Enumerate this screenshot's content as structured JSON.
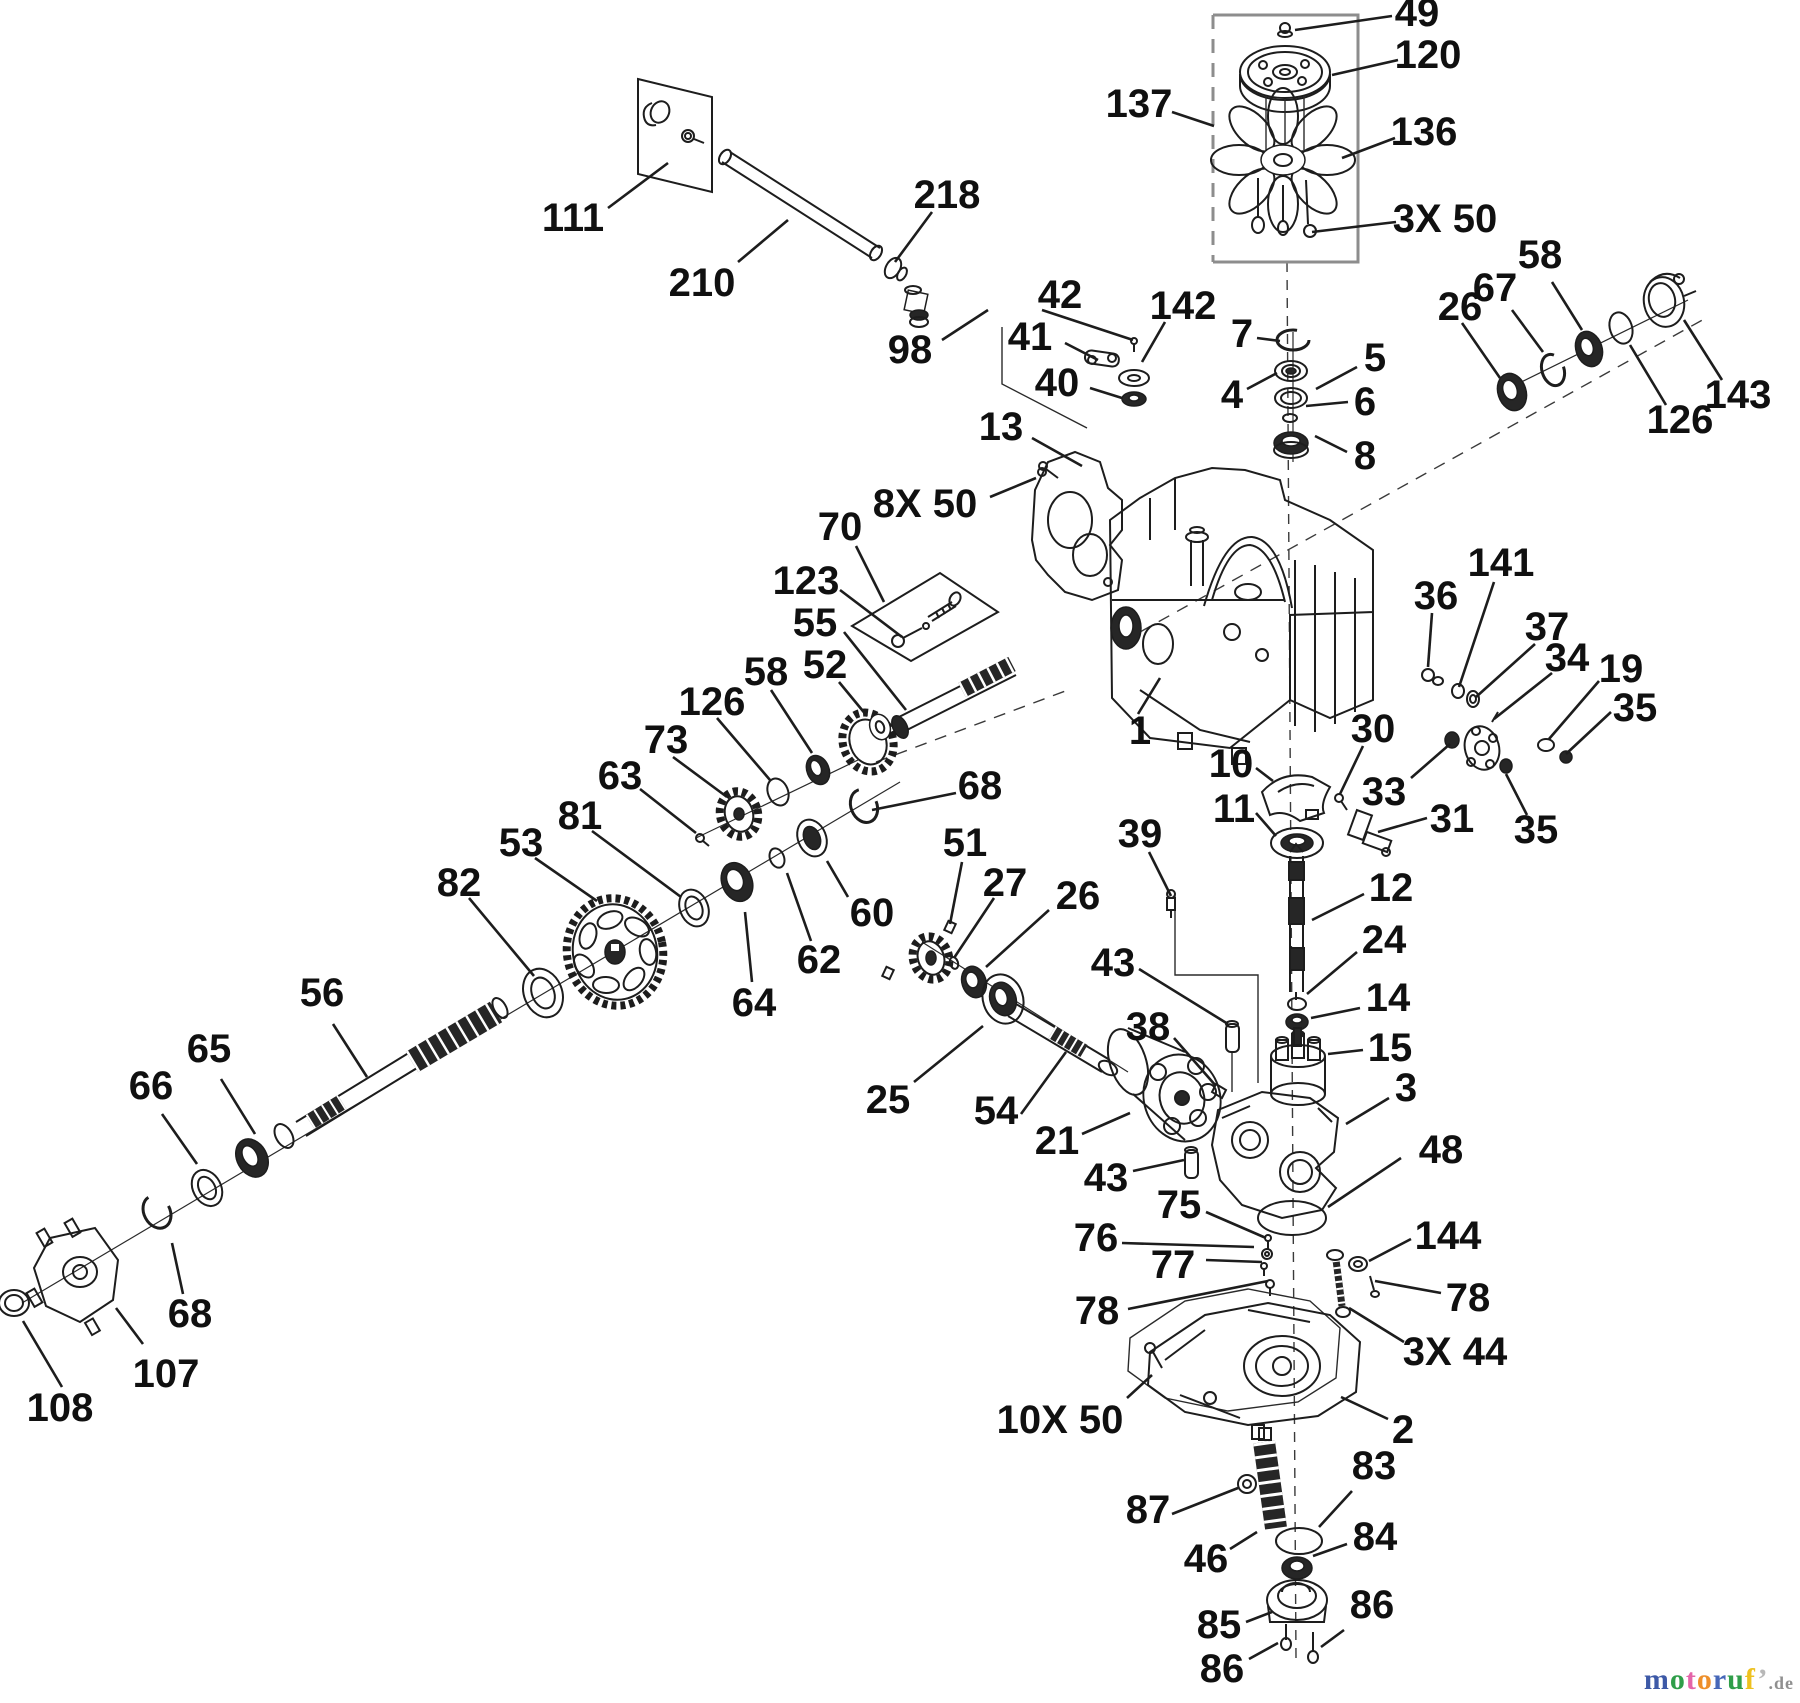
{
  "diagram": {
    "type": "exploded-parts-diagram",
    "ink_color": "#1d1d1d",
    "gray_color": "#8d8d8d",
    "background": "#ffffff"
  },
  "watermark": {
    "letters": [
      {
        "ch": "m",
        "color": "#3d59a7"
      },
      {
        "ch": "o",
        "color": "#2f9e49"
      },
      {
        "ch": "t",
        "color": "#e464a9"
      },
      {
        "ch": "o",
        "color": "#ee8f2a"
      },
      {
        "ch": "r",
        "color": "#4667b8"
      },
      {
        "ch": "u",
        "color": "#2f9e49"
      },
      {
        "ch": "f",
        "color": "#eec11f"
      },
      {
        "ch": "’",
        "color": "#b8b8b8"
      }
    ],
    "suffix": ".de",
    "suffix_color": "#909090"
  },
  "labels": [
    {
      "t": "49",
      "x": 1417,
      "y": 13,
      "l": [
        1392,
        16,
        1295,
        30
      ]
    },
    {
      "t": "120",
      "x": 1428,
      "y": 55,
      "l": [
        1398,
        60,
        1332,
        75
      ]
    },
    {
      "t": "137",
      "x": 1139,
      "y": 104,
      "l": [
        1172,
        112,
        1214,
        126
      ]
    },
    {
      "t": "136",
      "x": 1424,
      "y": 132,
      "l": [
        1395,
        138,
        1342,
        158
      ]
    },
    {
      "t": "3X 50",
      "x": 1445,
      "y": 219,
      "l": [
        1396,
        222,
        1312,
        232
      ]
    },
    {
      "t": "111",
      "x": 573,
      "y": 218,
      "l": [
        608,
        208,
        668,
        163
      ]
    },
    {
      "t": "210",
      "x": 702,
      "y": 283,
      "l": [
        738,
        262,
        788,
        220
      ]
    },
    {
      "t": "218",
      "x": 947,
      "y": 195,
      "l": [
        932,
        212,
        895,
        262
      ]
    },
    {
      "t": "98",
      "x": 910,
      "y": 350,
      "l": [
        942,
        340,
        988,
        310
      ]
    },
    {
      "t": "42",
      "x": 1060,
      "y": 295,
      "l": [
        1042,
        310,
        1133,
        340
      ]
    },
    {
      "t": "41",
      "x": 1030,
      "y": 337,
      "l": [
        1065,
        343,
        1098,
        360
      ]
    },
    {
      "t": "40",
      "x": 1057,
      "y": 383,
      "l": [
        1090,
        388,
        1122,
        398
      ]
    },
    {
      "t": "142",
      "x": 1183,
      "y": 306,
      "l": [
        1165,
        322,
        1142,
        362
      ]
    },
    {
      "t": "7",
      "x": 1242,
      "y": 334,
      "l": [
        1257,
        338,
        1280,
        341
      ]
    },
    {
      "t": "4",
      "x": 1232,
      "y": 395,
      "l": [
        1247,
        389,
        1277,
        373
      ]
    },
    {
      "t": "5",
      "x": 1375,
      "y": 358,
      "l": [
        1357,
        367,
        1316,
        389
      ]
    },
    {
      "t": "6",
      "x": 1365,
      "y": 402,
      "l": [
        1348,
        402,
        1306,
        406
      ]
    },
    {
      "t": "8",
      "x": 1365,
      "y": 456,
      "l": [
        1347,
        452,
        1315,
        436
      ]
    },
    {
      "t": "13",
      "x": 1001,
      "y": 427,
      "l": [
        1032,
        438,
        1082,
        466
      ]
    },
    {
      "t": "8X 50",
      "x": 925,
      "y": 504,
      "l": [
        990,
        497,
        1036,
        478
      ]
    },
    {
      "t": "26",
      "x": 1460,
      "y": 307,
      "l": [
        1462,
        323,
        1500,
        378
      ]
    },
    {
      "t": "67",
      "x": 1495,
      "y": 288,
      "l": [
        1512,
        310,
        1543,
        352
      ]
    },
    {
      "t": "58",
      "x": 1540,
      "y": 255,
      "l": [
        1552,
        282,
        1582,
        330
      ]
    },
    {
      "t": "143",
      "x": 1738,
      "y": 395,
      "l": [
        1722,
        380,
        1684,
        320
      ]
    },
    {
      "t": "126",
      "x": 1680,
      "y": 420,
      "l": [
        1666,
        405,
        1630,
        345
      ]
    },
    {
      "t": "70",
      "x": 840,
      "y": 527,
      "l": [
        856,
        546,
        884,
        602
      ]
    },
    {
      "t": "123",
      "x": 806,
      "y": 581,
      "l": [
        840,
        590,
        902,
        637
      ]
    },
    {
      "t": "55",
      "x": 815,
      "y": 623,
      "l": [
        844,
        632,
        906,
        710
      ]
    },
    {
      "t": "52",
      "x": 825,
      "y": 665,
      "l": [
        839,
        682,
        867,
        716
      ]
    },
    {
      "t": "58",
      "x": 766,
      "y": 672,
      "l": [
        771,
        690,
        812,
        753
      ]
    },
    {
      "t": "126",
      "x": 712,
      "y": 702,
      "l": [
        717,
        718,
        770,
        780
      ]
    },
    {
      "t": "73",
      "x": 666,
      "y": 740,
      "l": [
        673,
        757,
        727,
        797
      ]
    },
    {
      "t": "63",
      "x": 620,
      "y": 776,
      "l": [
        640,
        789,
        696,
        833
      ]
    },
    {
      "t": "81",
      "x": 580,
      "y": 816,
      "l": [
        592,
        831,
        681,
        897
      ]
    },
    {
      "t": "53",
      "x": 521,
      "y": 843,
      "l": [
        535,
        858,
        597,
        901
      ]
    },
    {
      "t": "82",
      "x": 459,
      "y": 883,
      "l": [
        469,
        898,
        534,
        976
      ]
    },
    {
      "t": "68",
      "x": 980,
      "y": 786,
      "l": [
        956,
        793,
        872,
        810
      ]
    },
    {
      "t": "1",
      "x": 1140,
      "y": 731,
      "l": [
        1138,
        714,
        1160,
        678
      ]
    },
    {
      "t": "36",
      "x": 1436,
      "y": 596,
      "l": [
        1432,
        613,
        1428,
        667
      ]
    },
    {
      "t": "141",
      "x": 1501,
      "y": 563,
      "l": [
        1494,
        582,
        1459,
        687
      ]
    },
    {
      "t": "37",
      "x": 1547,
      "y": 627,
      "l": [
        1535,
        644,
        1476,
        697
      ]
    },
    {
      "t": "34",
      "x": 1567,
      "y": 658,
      "l": [
        1552,
        673,
        1494,
        719
      ]
    },
    {
      "t": "19",
      "x": 1621,
      "y": 669,
      "l": [
        1599,
        681,
        1549,
        739
      ]
    },
    {
      "t": "35",
      "x": 1635,
      "y": 708,
      "l": [
        1611,
        712,
        1566,
        754
      ]
    },
    {
      "t": "30",
      "x": 1373,
      "y": 729,
      "l": [
        1363,
        746,
        1340,
        794
      ]
    },
    {
      "t": "10",
      "x": 1231,
      "y": 764,
      "l": [
        1256,
        768,
        1273,
        781
      ]
    },
    {
      "t": "11",
      "x": 1234,
      "y": 809,
      "l": [
        1256,
        813,
        1276,
        836
      ]
    },
    {
      "t": "33",
      "x": 1384,
      "y": 792,
      "l": [
        1411,
        778,
        1450,
        744
      ]
    },
    {
      "t": "31",
      "x": 1452,
      "y": 819,
      "l": [
        1427,
        818,
        1378,
        832
      ]
    },
    {
      "t": "35",
      "x": 1536,
      "y": 830,
      "l": [
        1527,
        815,
        1506,
        774
      ]
    },
    {
      "t": "39",
      "x": 1140,
      "y": 834,
      "l": [
        1149,
        852,
        1171,
        896
      ]
    },
    {
      "t": "12",
      "x": 1391,
      "y": 888,
      "l": [
        1364,
        894,
        1312,
        920
      ]
    },
    {
      "t": "24",
      "x": 1384,
      "y": 940,
      "l": [
        1357,
        952,
        1307,
        994
      ]
    },
    {
      "t": "14",
      "x": 1388,
      "y": 998,
      "l": [
        1360,
        1008,
        1311,
        1018
      ]
    },
    {
      "t": "15",
      "x": 1390,
      "y": 1048,
      "l": [
        1363,
        1050,
        1328,
        1054
      ]
    },
    {
      "t": "3",
      "x": 1406,
      "y": 1088,
      "l": [
        1389,
        1098,
        1346,
        1124
      ]
    },
    {
      "t": "48",
      "x": 1441,
      "y": 1150,
      "l": [
        1401,
        1158,
        1328,
        1207
      ]
    },
    {
      "t": "51",
      "x": 965,
      "y": 843,
      "l": [
        962,
        862,
        950,
        924
      ]
    },
    {
      "t": "27",
      "x": 1005,
      "y": 883,
      "l": [
        994,
        898,
        954,
        958
      ]
    },
    {
      "t": "26",
      "x": 1078,
      "y": 896,
      "l": [
        1049,
        910,
        986,
        967
      ]
    },
    {
      "t": "60",
      "x": 872,
      "y": 913,
      "l": [
        848,
        897,
        827,
        861
      ]
    },
    {
      "t": "62",
      "x": 819,
      "y": 960,
      "l": [
        811,
        941,
        787,
        873
      ]
    },
    {
      "t": "64",
      "x": 754,
      "y": 1003,
      "l": [
        752,
        982,
        745,
        912
      ]
    },
    {
      "t": "25",
      "x": 888,
      "y": 1100,
      "l": [
        914,
        1082,
        983,
        1026
      ]
    },
    {
      "t": "54",
      "x": 996,
      "y": 1111,
      "l": [
        1021,
        1114,
        1066,
        1052
      ]
    },
    {
      "t": "21",
      "x": 1057,
      "y": 1141,
      "l": [
        1082,
        1134,
        1130,
        1113
      ]
    },
    {
      "t": "43",
      "x": 1113,
      "y": 963,
      "l": [
        1139,
        969,
        1228,
        1024
      ]
    },
    {
      "t": "38",
      "x": 1148,
      "y": 1027,
      "l": [
        1174,
        1038,
        1216,
        1086
      ]
    },
    {
      "t": "43",
      "x": 1106,
      "y": 1178,
      "l": [
        1133,
        1171,
        1184,
        1160
      ]
    },
    {
      "t": "75",
      "x": 1179,
      "y": 1205,
      "l": [
        1206,
        1212,
        1266,
        1238
      ]
    },
    {
      "t": "76",
      "x": 1096,
      "y": 1238,
      "l": [
        1122,
        1243,
        1254,
        1247
      ]
    },
    {
      "t": "77",
      "x": 1173,
      "y": 1265,
      "l": [
        1206,
        1260,
        1262,
        1262
      ]
    },
    {
      "t": "78",
      "x": 1097,
      "y": 1311,
      "l": [
        1128,
        1309,
        1268,
        1281
      ]
    },
    {
      "t": "144",
      "x": 1448,
      "y": 1236,
      "l": [
        1411,
        1239,
        1369,
        1261
      ]
    },
    {
      "t": "78",
      "x": 1468,
      "y": 1298,
      "l": [
        1441,
        1293,
        1375,
        1281
      ]
    },
    {
      "t": "3X 44",
      "x": 1455,
      "y": 1352,
      "l": [
        1404,
        1342,
        1349,
        1308
      ]
    },
    {
      "t": "10X 50",
      "x": 1060,
      "y": 1420,
      "l": [
        1127,
        1398,
        1152,
        1375
      ]
    },
    {
      "t": "2",
      "x": 1403,
      "y": 1430,
      "l": [
        1388,
        1419,
        1341,
        1397
      ]
    },
    {
      "t": "83",
      "x": 1374,
      "y": 1466,
      "l": [
        1352,
        1491,
        1319,
        1527
      ]
    },
    {
      "t": "87",
      "x": 1148,
      "y": 1510,
      "l": [
        1172,
        1514,
        1238,
        1488
      ]
    },
    {
      "t": "46",
      "x": 1206,
      "y": 1559,
      "l": [
        1230,
        1549,
        1257,
        1532
      ]
    },
    {
      "t": "84",
      "x": 1375,
      "y": 1537,
      "l": [
        1347,
        1544,
        1313,
        1556
      ]
    },
    {
      "t": "85",
      "x": 1219,
      "y": 1625,
      "l": [
        1246,
        1622,
        1272,
        1612
      ]
    },
    {
      "t": "86",
      "x": 1372,
      "y": 1605,
      "l": [
        1344,
        1630,
        1321,
        1647
      ]
    },
    {
      "t": "86",
      "x": 1222,
      "y": 1669,
      "l": [
        1249,
        1659,
        1278,
        1643
      ]
    },
    {
      "t": "56",
      "x": 322,
      "y": 993,
      "l": [
        333,
        1024,
        367,
        1077
      ]
    },
    {
      "t": "65",
      "x": 209,
      "y": 1049,
      "l": [
        221,
        1079,
        255,
        1134
      ]
    },
    {
      "t": "66",
      "x": 151,
      "y": 1086,
      "l": [
        162,
        1114,
        197,
        1164
      ]
    },
    {
      "t": "68",
      "x": 190,
      "y": 1314,
      "l": [
        183,
        1294,
        172,
        1243
      ]
    },
    {
      "t": "107",
      "x": 166,
      "y": 1374,
      "l": [
        143,
        1344,
        116,
        1308
      ]
    },
    {
      "t": "108",
      "x": 60,
      "y": 1408,
      "l": [
        62,
        1387,
        23,
        1321
      ]
    }
  ],
  "aux_lines": [
    {
      "pts": [
        [
          1287,
          262
        ],
        [
          1296,
          1658
        ]
      ],
      "dash": "10 8",
      "w": 1.4,
      "c": "#3a3a3a"
    },
    {
      "pts": [
        [
          1122,
          642
        ],
        [
          1706,
          318
        ]
      ],
      "dash": "12 9",
      "w": 1.4,
      "c": "#3a3a3a"
    },
    {
      "pts": [
        [
          876,
          762
        ],
        [
          1068,
          690
        ]
      ],
      "dash": "12 9",
      "w": 1.4,
      "c": "#3a3a3a"
    },
    {
      "pts": [
        [
          1002,
          327
        ],
        [
          1002,
          384
        ],
        [
          1087,
          428
        ]
      ],
      "dash": "none",
      "w": 1.4,
      "c": "#2a2a2a"
    },
    {
      "pts": [
        [
          1175,
          893
        ],
        [
          1175,
          975
        ],
        [
          1258,
          975
        ],
        [
          1258,
          1083
        ]
      ],
      "dash": "none",
      "w": 1.4,
      "c": "#2a2a2a"
    },
    {
      "pts": [
        [
          1232,
          1052
        ],
        [
          1232,
          1092
        ]
      ],
      "dash": "none",
      "w": 1.4,
      "c": "#2a2a2a"
    },
    {
      "pts": [
        [
          22,
          1303
        ],
        [
          900,
          782
        ]
      ],
      "dash": "none",
      "w": 1.2,
      "c": "#2a2a2a"
    },
    {
      "pts": [
        [
          696,
          838
        ],
        [
          858,
          760
        ]
      ],
      "dash": "none",
      "w": 1.2,
      "c": "#2a2a2a"
    },
    {
      "pts": [
        [
          922,
          942
        ],
        [
          1128,
          1072
        ]
      ],
      "dash": "none",
      "w": 1.2,
      "c": "#2a2a2a"
    },
    {
      "pts": [
        [
          1505,
          390
        ],
        [
          1688,
          300
        ]
      ],
      "dash": "none",
      "w": 1.2,
      "c": "#2a2a2a"
    },
    {
      "pts": [
        [
          1293,
          332
        ],
        [
          1293,
          462
        ]
      ],
      "dash": "none",
      "w": 1.2,
      "c": "#2a2a2a"
    }
  ]
}
